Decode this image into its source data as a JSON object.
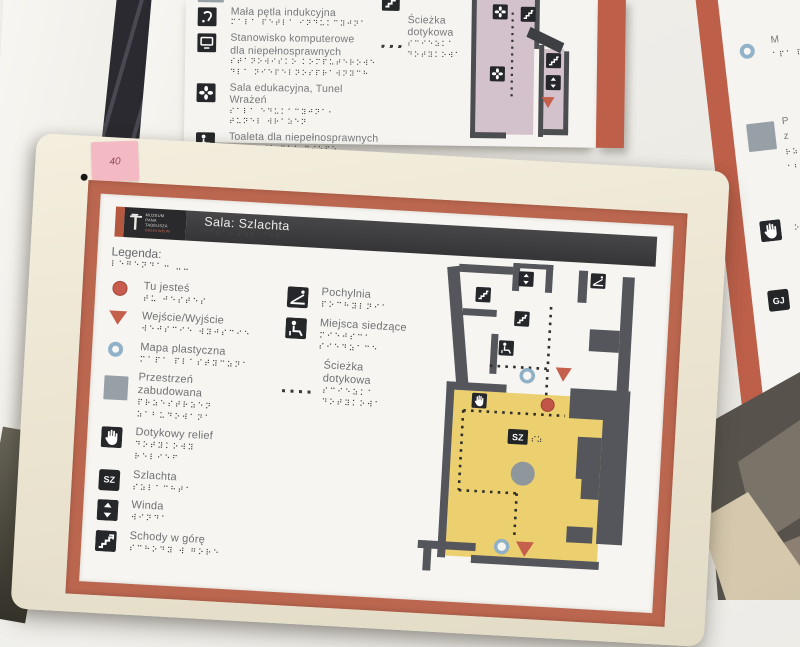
{
  "colors": {
    "frame_cream": "#ece5d2",
    "border_terracotta": "#bb6750",
    "panel_white": "#f6f5f1",
    "header_dark": "#3b3b3d",
    "room_yellow": "#ecd06f",
    "wall_gray": "#54565b",
    "accent_red": "#c4604c",
    "ring_blue": "#92b2c9",
    "built_area_gray": "#98a0a7",
    "lavender_room": "#d3c2cc",
    "note_pink": "#f3bac4"
  },
  "photo": {
    "sticky_note_text": "40"
  },
  "main_sign": {
    "logo": {
      "lines": [
        "MUZEUM",
        "PANA",
        "TADEUSZA"
      ],
      "sub": "OSSOLINEUM"
    },
    "header": {
      "title": "Sala: Szlachta",
      "braille": "⠎⠁⠇⠁⠒ ⠎⠵⠇⠁⠉⠓⠞⠁"
    },
    "legend_title": {
      "label": "Legenda:",
      "braille": "⠇⠑⠛⠑⠝⠙⠁⠒ ⠤⠤"
    },
    "legend_left": [
      {
        "icon": "you-are-here-dot",
        "label": "Tu jesteś",
        "braille": "⠞⠥ ⠚⠑⠎⠞⠑⠎"
      },
      {
        "icon": "entrance-exit-triangle",
        "label": "Wejście/Wyjście",
        "braille": "⠺⠑⠚⠎⠉⠊⠑ ⠺⠽⠚⠎⠉⠊⠑"
      },
      {
        "icon": "tactile-map-ring",
        "label": "Mapa plastyczna",
        "braille": "⠍⠁⠏⠁ ⠏⠇⠁⠎⠞⠽⠉⠵⠝⠁"
      },
      {
        "icon": "built-up-area-square",
        "label": "Przestrzeń",
        "label2": "zabudowana",
        "braille": "⠏⠗⠵⠑⠎⠞⠗⠵⠑⠝",
        "braille2": "⠵⠁⠃⠥⠙⠕⠺⠁⠝⠁"
      },
      {
        "icon": "tactile-relief-hand",
        "label": "Dotykowy relief",
        "braille": "⠙⠕⠞⠽⠅⠕⠺⠽",
        "braille2": "⠗⠑⠇⠊⠑⠋"
      },
      {
        "icon": "room-code-tile",
        "tile": "SZ",
        "label": "Szlachta",
        "braille": "⠎⠵⠇⠁⠉⠓⠞⠁"
      },
      {
        "icon": "elevator",
        "label": "Winda",
        "braille": "⠺⠊⠝⠙⠁"
      },
      {
        "icon": "stairs-up",
        "label": "Schody w górę",
        "braille": "⠎⠉⠓⠕⠙⠽ ⠺ ⠛⠕⠗⠑"
      }
    ],
    "legend_right": [
      {
        "icon": "ramp",
        "label": "Pochylnia",
        "braille": "⠏⠕⠉⠓⠽⠇⠝⠊⠁"
      },
      {
        "icon": "seating",
        "label": "Miejsca siedzące",
        "braille": "⠍⠊⠑⠚⠎⠉⠁",
        "braille2": "⠎⠊⠑⠙⠵⠁⠉⠑"
      },
      {
        "icon": "dotted-tactile-path",
        "label": "Ścieżka",
        "label2": "dotykowa",
        "braille": "⠎⠉⠊⠑⠵⠅⠁",
        "braille2": "⠙⠕⠞⠽⠅⠕⠺⠁"
      }
    ],
    "map": {
      "room_tile": "SZ",
      "room_tile_braille": "⠎⠵",
      "markers": [
        "stairs",
        "elevator",
        "ramp",
        "stairs",
        "seating",
        "tactile-map",
        "entrance",
        "tactile-relief",
        "you-are-here",
        "room-code",
        "built-up-column",
        "tactile-map",
        "entrance"
      ]
    }
  },
  "top_sign": {
    "items": [
      {
        "icon": "built-up-area-square-partial",
        "braille": "⠵⠁⠃⠥⠙⠕⠺⠁⠝⠁ ⠒⠒"
      },
      {
        "icon": "induction-loop",
        "label": "Mała pętla indukcyjna",
        "braille": "⠍⠁⠇⠁ ⠏⠑⠞⠇⠁ ⠊⠝⠙⠥⠅⠉⠽⠚⠝⠁"
      },
      {
        "icon": "computer-workstation",
        "label": "Stanowisko komputerowe",
        "label2": "dla niepełnosprawnych",
        "braille": "⠎⠞⠁⠝⠕⠺⠊⠎⠅⠕ ⠅⠕⠍⠏⠥⠞⠑⠗⠕⠺⠑",
        "braille2": "⠙⠇⠁ ⠝⠊⠑⠏⠑⠇⠝⠕⠎⠏⠗⠁⠺⠝⠽⠉⠓"
      },
      {
        "icon": "education-room",
        "label": "Sala edukacyjna, Tunel Wrażeń",
        "braille": "⠎⠁⠇⠁ ⠑⠙⠥⠅⠁⠉⠽⠚⠝⠁⠂",
        "braille2": "⠞⠥⠝⠑⠇ ⠺⠗⠁⠵⠑⠝"
      },
      {
        "icon": "accessible-toilet",
        "label": "Toaleta dla niepełnosprawnych",
        "braille": "⠞⠕⠁⠇⠑⠞⠁ ⠙⠇⠁ ⠝⠊⠑⠏⠑⠤",
        "braille2": "⠇⠝⠕⠎⠏⠗⠁⠺⠝⠽⠉⠓"
      },
      {
        "icon": "elevator",
        "label": "Winda",
        "braille": "⠺⠊⠝⠙⠁"
      }
    ],
    "right_item": {
      "icon_top": "stairs",
      "braille_top": "⠎⠉⠓⠕⠙⠽ ⠺ ⠙⠕⠇",
      "label": "Ścieżka",
      "label2": "dotykowa",
      "icon": "dotted-tactile-path",
      "braille": "⠎⠉⠊⠑⠵⠅⠁",
      "braille2": "⠙⠕⠞⠽⠅⠕⠺⠁"
    }
  },
  "right_sign": {
    "tile": "GJ",
    "fragments": [
      {
        "text": "M",
        "braille": "⠁⠏⠁ ⠏⠇⠁"
      },
      {
        "text": "P",
        "braille": "⠗⠵⠑⠎⠞⠗⠵"
      },
      {
        "text": "z",
        "braille": "⠁⠃⠥⠙⠕⠺"
      },
      {
        "text": "",
        "braille": "⠕⠞⠽⠅⠕⠺"
      },
      {
        "text": "",
        "braille": "⠎⠵⠇⠁⠉⠓"
      }
    ]
  }
}
